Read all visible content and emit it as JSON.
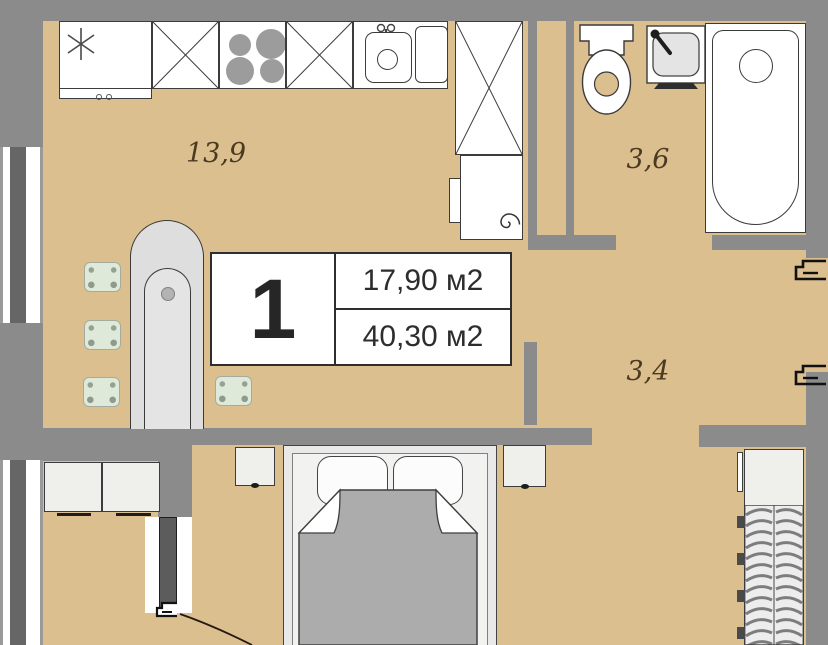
{
  "plan": {
    "title": "Apartment floor plan",
    "unit": {
      "number": "1",
      "living_area": "17,90 м2",
      "total_area": "40,30 м2"
    },
    "rooms": [
      {
        "name": "kitchen-living-room",
        "area": "13,9"
      },
      {
        "name": "bathroom",
        "area": "3,6"
      },
      {
        "name": "hallway",
        "area": "3,4"
      }
    ],
    "colors": {
      "floor": "#dcbf8e",
      "wall": "#8b8b8b",
      "window_mullion": "#666666",
      "fixture_light_gray": "#e9e9e9",
      "blanket_gray": "#acacac",
      "stool_green": "#dfe9d9",
      "label_text": "#4a3a22"
    },
    "icons": [
      "snowflake-fridge-icon",
      "burner-icon",
      "faucet-icon",
      "spiral-heater-icon",
      "toilet-icon",
      "washbasin-icon",
      "bathtub-icon",
      "door-swing-icon",
      "hanger-rail-icon",
      "entry-door-mark-icon"
    ]
  }
}
